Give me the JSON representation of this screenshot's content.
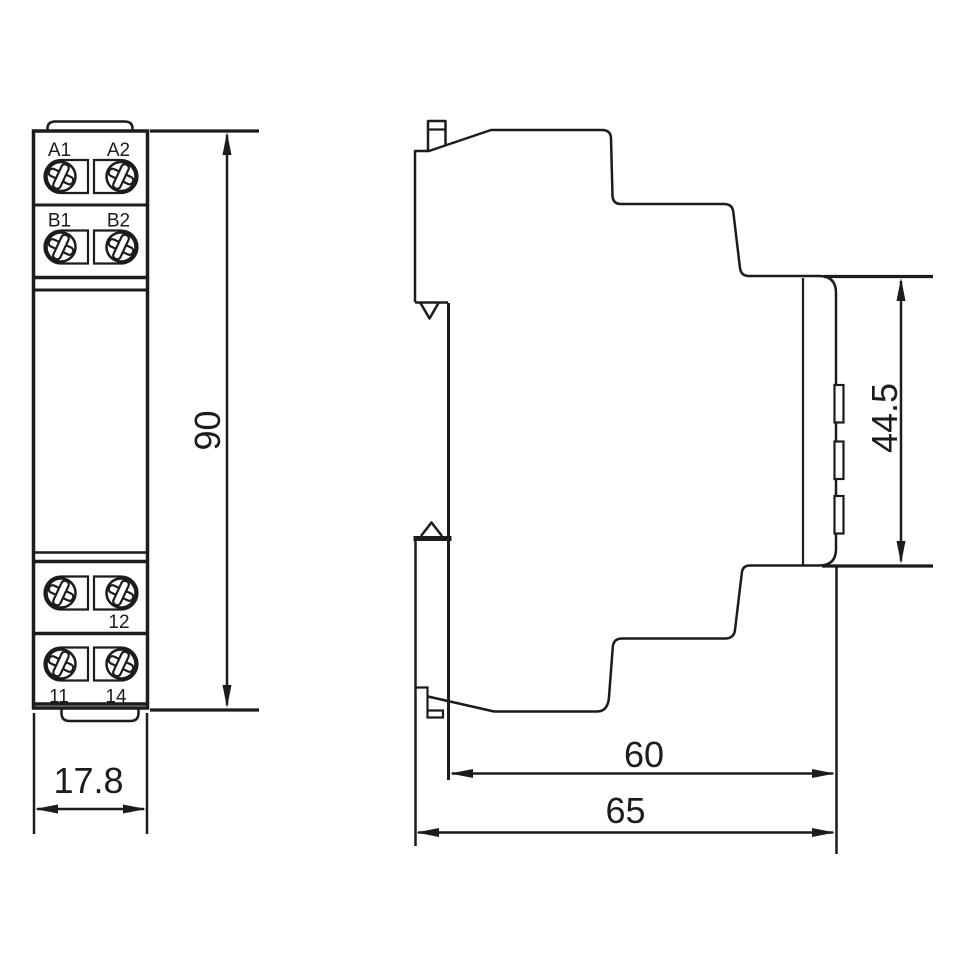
{
  "drawing": {
    "type": "dimension-drawing",
    "views": [
      "front",
      "side"
    ],
    "front_view": {
      "terminal_labels": {
        "a1": "A1",
        "a2": "A2",
        "b1": "B1",
        "b2": "B2",
        "t12": "12",
        "t11": "11",
        "t14": "14"
      },
      "dimensions": {
        "height": "90",
        "width": "17.8"
      }
    },
    "side_view": {
      "dimensions": {
        "front_panel_height": "44.5",
        "depth_body": "60",
        "depth_total": "65"
      }
    },
    "colors": {
      "line": "#1c1c1c",
      "background": "#ffffff"
    }
  }
}
